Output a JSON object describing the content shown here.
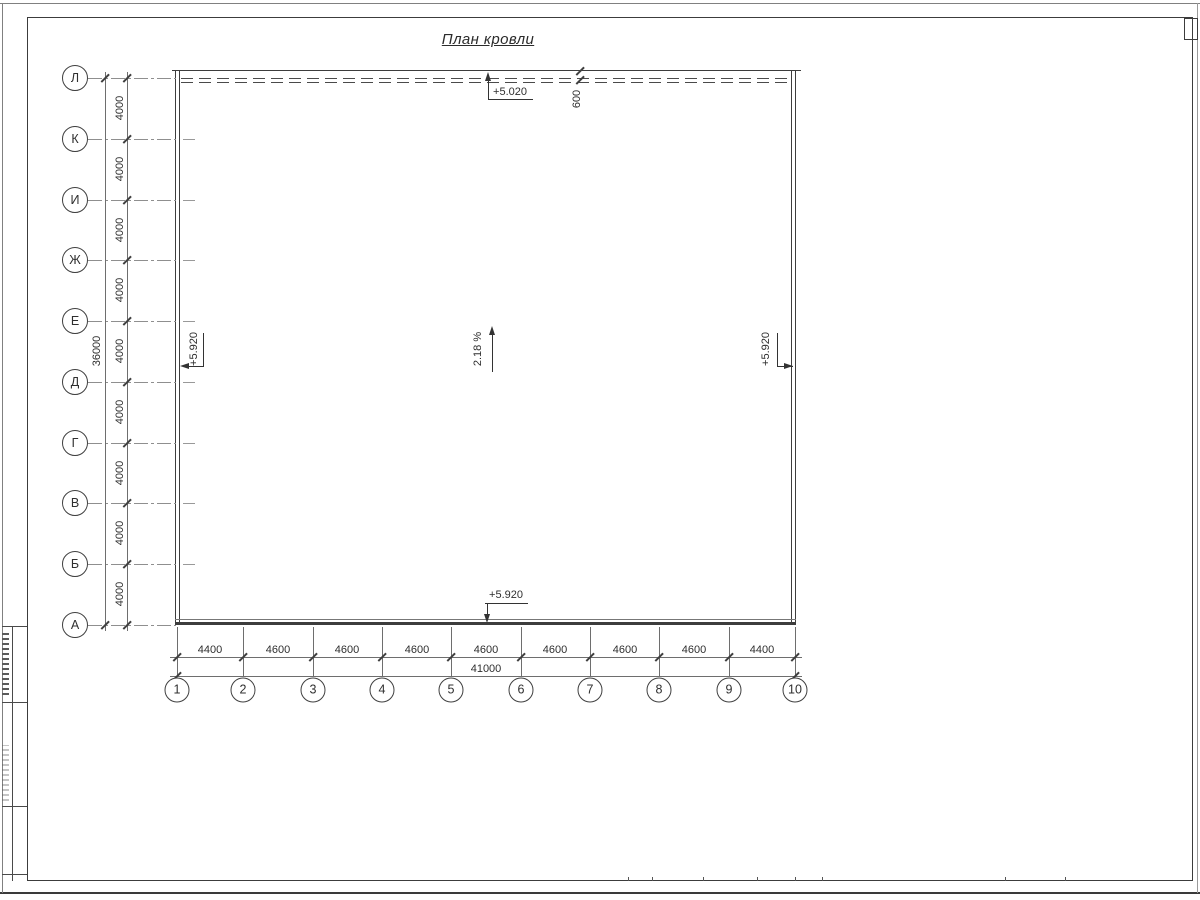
{
  "title": "План кровли",
  "axes": {
    "rows": [
      "Л",
      "К",
      "И",
      "Ж",
      "Е",
      "Д",
      "Г",
      "В",
      "Б",
      "А"
    ],
    "cols": [
      "1",
      "2",
      "3",
      "4",
      "5",
      "6",
      "7",
      "8",
      "9",
      "10"
    ]
  },
  "dimensions": {
    "left": {
      "segments": [
        "4000",
        "4000",
        "4000",
        "4000",
        "4000",
        "4000",
        "4000",
        "4000",
        "4000"
      ],
      "total": "36000"
    },
    "bottom": {
      "segments": [
        "4400",
        "4600",
        "4600",
        "4600",
        "4600",
        "4600",
        "4600",
        "4600",
        "4400"
      ],
      "total": "41000"
    },
    "top_offset": "600"
  },
  "elevations": {
    "top": "+5.020",
    "left": "+5.920",
    "right": "+5.920",
    "bottom": "+5.920"
  },
  "slope": "2.18 %",
  "colors": {
    "line_dark": "#3c3c3c",
    "line_medium": "#6e6e6e",
    "line_light": "#8f8f8f",
    "text": "#2f2f2f",
    "background": "#ffffff"
  }
}
